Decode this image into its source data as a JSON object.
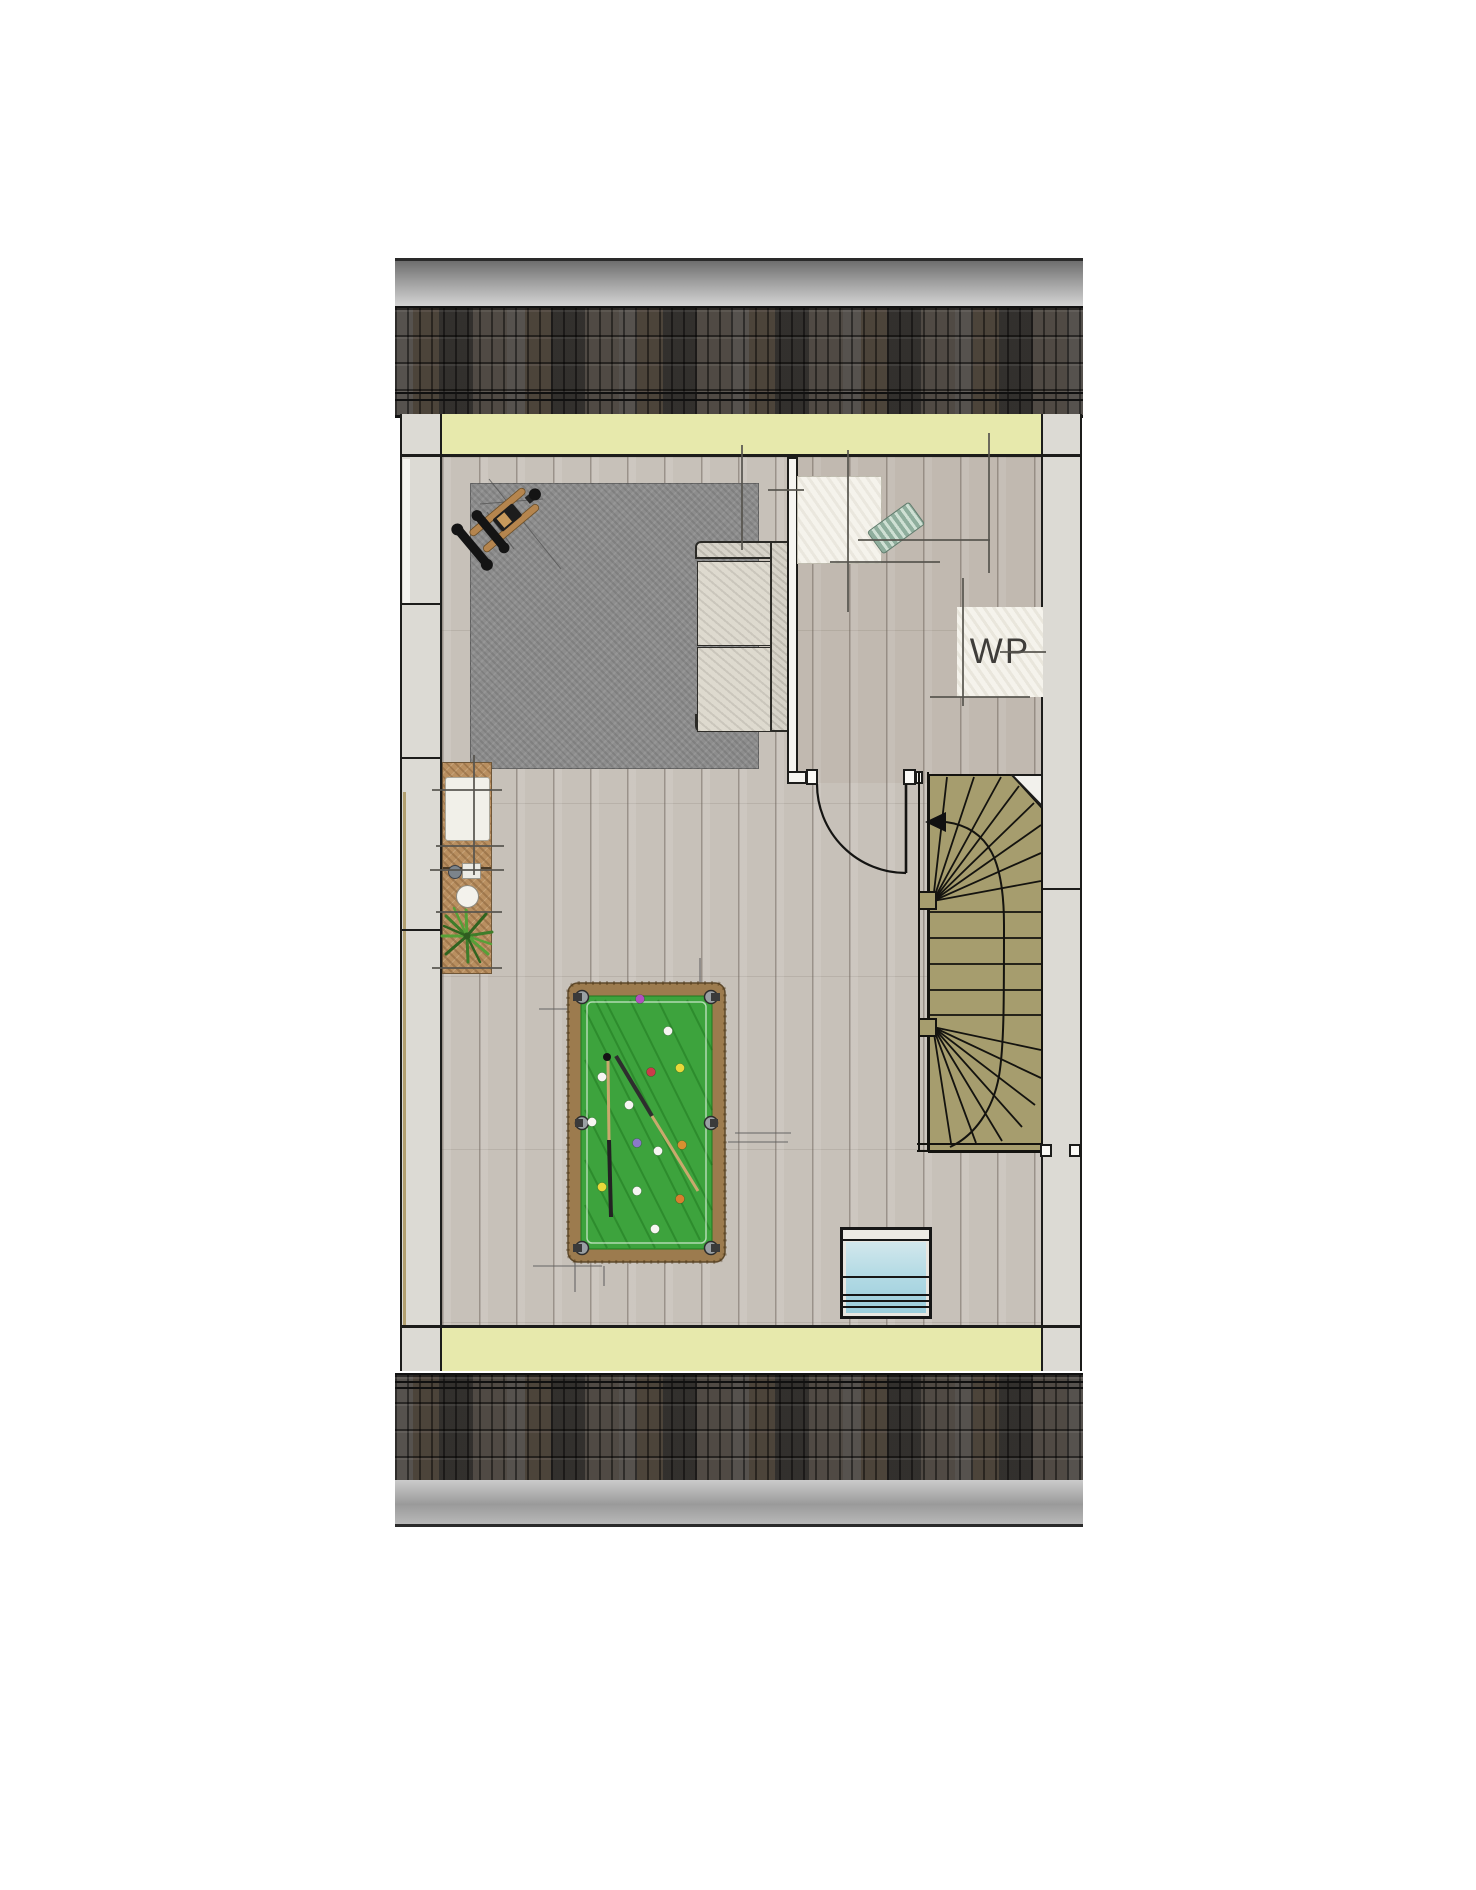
{
  "plan": {
    "kind": "architectural floor plan - attic level",
    "labels": {
      "heat_pump": "WP"
    },
    "palette": {
      "outline": "#1c1c1a",
      "roof_tiles": "#45413d",
      "ridge_gray": "#9b9b9b",
      "knee_wall_band": "#e7e9ac",
      "wall_fill": "#dcdad4",
      "floor_wood": "#c7c1b9",
      "rug_gray": "#8d8d8d",
      "stair_tread": "#a69d6e",
      "pool_felt": "#3da33d",
      "pool_frame": "#9c7b4e",
      "skylight_glass": "#aed6e2",
      "bench_wood": "#b98f60",
      "plant_green": "#4a8a33"
    },
    "objects": [
      "pitched-roof-tiles-top",
      "pitched-roof-tiles-bottom",
      "knee-wall-band-top",
      "knee-wall-band-bottom",
      "exterior-wall-left",
      "exterior-wall-right",
      "open-attic-room",
      "technical-room",
      "heat-pump-unit",
      "washing-machine-position",
      "two-seat-sofa",
      "area-rug",
      "exercise-equipment",
      "pool-table",
      "pool-cues",
      "pool-balls",
      "winder-staircase",
      "stair-up-arrow",
      "interior-door-with-swing",
      "roof-window",
      "window-bench",
      "bench-cushion",
      "tea-set",
      "potted-plant"
    ]
  }
}
